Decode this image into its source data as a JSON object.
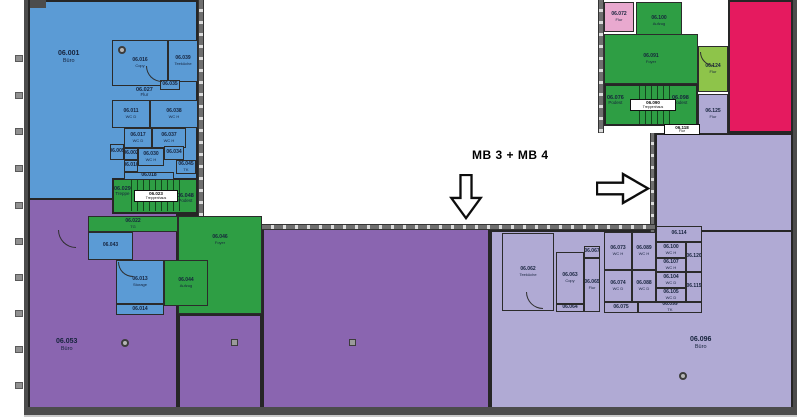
{
  "annotation": {
    "text": "MB 3 + MB 4"
  },
  "icons": {
    "down_arrow": "down-arrow",
    "right_arrow": "right-arrow"
  },
  "colors": {
    "blue": "#5b9bd5",
    "purple": "#8a65b0",
    "lavender": "#b0aad4",
    "green": "#2e9e44",
    "lightgreen": "#8ec44a",
    "pink": "#e9a9cf",
    "magenta": "#e51a5f",
    "wall": "#6f6f6f",
    "wall_dark": "#4c4c4c",
    "label": "#16233c"
  },
  "rooms": [
    {
      "id": "r001",
      "label": "06.001",
      "sub": "Büro"
    },
    {
      "id": "r016",
      "label": "06.016",
      "sub": "Copy"
    },
    {
      "id": "r039",
      "label": "06.039",
      "sub": "Teeküche"
    },
    {
      "id": "r035",
      "label": "06.035",
      "sub": ""
    },
    {
      "id": "r027",
      "label": "06.027",
      "sub": "Flur"
    },
    {
      "id": "r011",
      "label": "06.011",
      "sub": "WC D"
    },
    {
      "id": "r038",
      "label": "06.038",
      "sub": "WC H"
    },
    {
      "id": "r017",
      "label": "06.017",
      "sub": "WC D"
    },
    {
      "id": "r037",
      "label": "06.037",
      "sub": "WC H"
    },
    {
      "id": "r005",
      "label": "06.005",
      "sub": ""
    },
    {
      "id": "r002",
      "label": "06.002",
      "sub": ""
    },
    {
      "id": "r010",
      "label": "06.010",
      "sub": ""
    },
    {
      "id": "r030",
      "label": "06.030",
      "sub": "WC H"
    },
    {
      "id": "r034",
      "label": "06.034",
      "sub": ""
    },
    {
      "id": "r045",
      "label": "06.045",
      "sub": "TK"
    },
    {
      "id": "r018",
      "label": "06.018",
      "sub": ""
    },
    {
      "id": "r029",
      "label": "06.029",
      "sub": "Treppe"
    },
    {
      "id": "r023",
      "label": "06.023",
      "sub": "Treppenhaus"
    },
    {
      "id": "r048",
      "label": "06.048",
      "sub": "Podest"
    },
    {
      "id": "r022",
      "label": "06.022",
      "sub": "TG"
    },
    {
      "id": "r046",
      "label": "06.046",
      "sub": "Foyer"
    },
    {
      "id": "r044",
      "label": "06.044",
      "sub": "Aufzug"
    },
    {
      "id": "r043",
      "label": "06.043",
      "sub": ""
    },
    {
      "id": "r013",
      "label": "06.013",
      "sub": "Storage"
    },
    {
      "id": "r014",
      "label": "06.014",
      "sub": ""
    },
    {
      "id": "r053",
      "label": "06.053",
      "sub": "Büro"
    },
    {
      "id": "r072",
      "label": "06.072",
      "sub": "Flur"
    },
    {
      "id": "r100a",
      "label": "06.100",
      "sub": "Aufzug"
    },
    {
      "id": "r091",
      "label": "06.091",
      "sub": "Foyer"
    },
    {
      "id": "r124",
      "label": "06.124",
      "sub": "Flur"
    },
    {
      "id": "r076",
      "label": "06.076",
      "sub": "Podest"
    },
    {
      "id": "r090",
      "label": "06.090",
      "sub": "Treppenhaus"
    },
    {
      "id": "r098",
      "label": "06.098",
      "sub": "Podest"
    },
    {
      "id": "r125",
      "label": "06.125",
      "sub": "Flur"
    },
    {
      "id": "r118",
      "label": "06.118",
      "sub": "Flur"
    },
    {
      "id": "r062",
      "label": "06.062",
      "sub": "Teeküche"
    },
    {
      "id": "r063",
      "label": "06.063",
      "sub": "Copy"
    },
    {
      "id": "r067",
      "label": "06.067",
      "sub": ""
    },
    {
      "id": "r065",
      "label": "06.065",
      "sub": "Flur"
    },
    {
      "id": "r064",
      "label": "06.064",
      "sub": ""
    },
    {
      "id": "r073",
      "label": "06.073",
      "sub": "WC H"
    },
    {
      "id": "r074",
      "label": "06.074",
      "sub": "WC D"
    },
    {
      "id": "r075",
      "label": "06.075",
      "sub": ""
    },
    {
      "id": "r089",
      "label": "06.089",
      "sub": "WC H"
    },
    {
      "id": "r088",
      "label": "06.088",
      "sub": "WC D"
    },
    {
      "id": "r114",
      "label": "06.114",
      "sub": ""
    },
    {
      "id": "r100b",
      "label": "06.100",
      "sub": "WC H"
    },
    {
      "id": "r107",
      "label": "06.107",
      "sub": "WC H"
    },
    {
      "id": "r104",
      "label": "06.104",
      "sub": "WC D"
    },
    {
      "id": "r105",
      "label": "06.105",
      "sub": "WC D"
    },
    {
      "id": "r120",
      "label": "06.120",
      "sub": ""
    },
    {
      "id": "r115",
      "label": "06.115",
      "sub": ""
    },
    {
      "id": "r099",
      "label": "06.099",
      "sub": "TK"
    },
    {
      "id": "r096",
      "label": "06.096",
      "sub": "Büro"
    }
  ]
}
